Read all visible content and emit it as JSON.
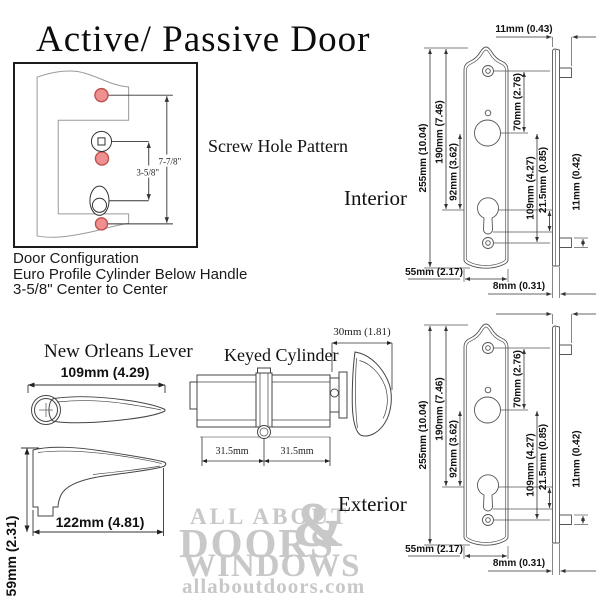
{
  "title": "Active/ Passive Door",
  "screw_pattern": {
    "caption": "Screw Hole Pattern",
    "dim_center_long": "7-7/8\"",
    "dim_center_short": "3-5/8\""
  },
  "door_config": {
    "line1": "Door Configuration",
    "line2": "Euro Profile Cylinder Below Handle",
    "line3": "3-5/8\" Center to Center"
  },
  "interior": {
    "label": "Interior",
    "dim_profile_width": "11mm (0.43)",
    "dim_height": "255mm (10.04)",
    "dim_top_to_cylinder": "190mm (7.46)",
    "dim_spindle_to_cylinder": "92mm (3.62)",
    "dim_screw_to_spindle": "70mm (2.76)",
    "dim_spindle_to_screw": "109mm (4.27)",
    "dim_cylinder_offset": "21.5mm (0.85)",
    "dim_tab": "11mm (0.42)",
    "dim_plate_width": "55mm (2.17)",
    "dim_plate_thickness": "8mm (0.31)"
  },
  "exterior": {
    "label": "Exterior",
    "dim_height": "255mm (10.04)",
    "dim_top_to_cylinder": "190mm (7.46)",
    "dim_spindle_to_cylinder": "92mm (3.62)",
    "dim_screw_to_spindle": "70mm (2.76)",
    "dim_spindle_to_screw": "109mm (4.27)",
    "dim_cylinder_offset": "21.5mm (0.85)",
    "dim_tab": "11mm (0.42)",
    "dim_plate_width": "55mm (2.17)",
    "dim_plate_thickness": "8mm (0.31)"
  },
  "lever": {
    "label": "New Orleans Lever",
    "dim_top_length": "109mm (4.29)",
    "dim_side_length": "122mm (4.81)",
    "dim_height": "59mm (2.31)"
  },
  "cylinder": {
    "label": "Keyed Cylinder",
    "dim_thumbturn": "30mm (1.81)",
    "dim_left_half": "31.5mm",
    "dim_right_half": "31.5mm"
  },
  "watermark": {
    "line1": "ALL ABOUT",
    "ampersand": "&",
    "line2": "DOORS",
    "line3": "WINDOWS",
    "url": "allaboutdoors.com"
  },
  "colors": {
    "screw_hole_fill": "#ef9090",
    "screw_hole_stroke": "#c0504d",
    "line_dark": "#333333",
    "line_plate": "#555555",
    "watermark_gray": "#c8c8c8"
  }
}
